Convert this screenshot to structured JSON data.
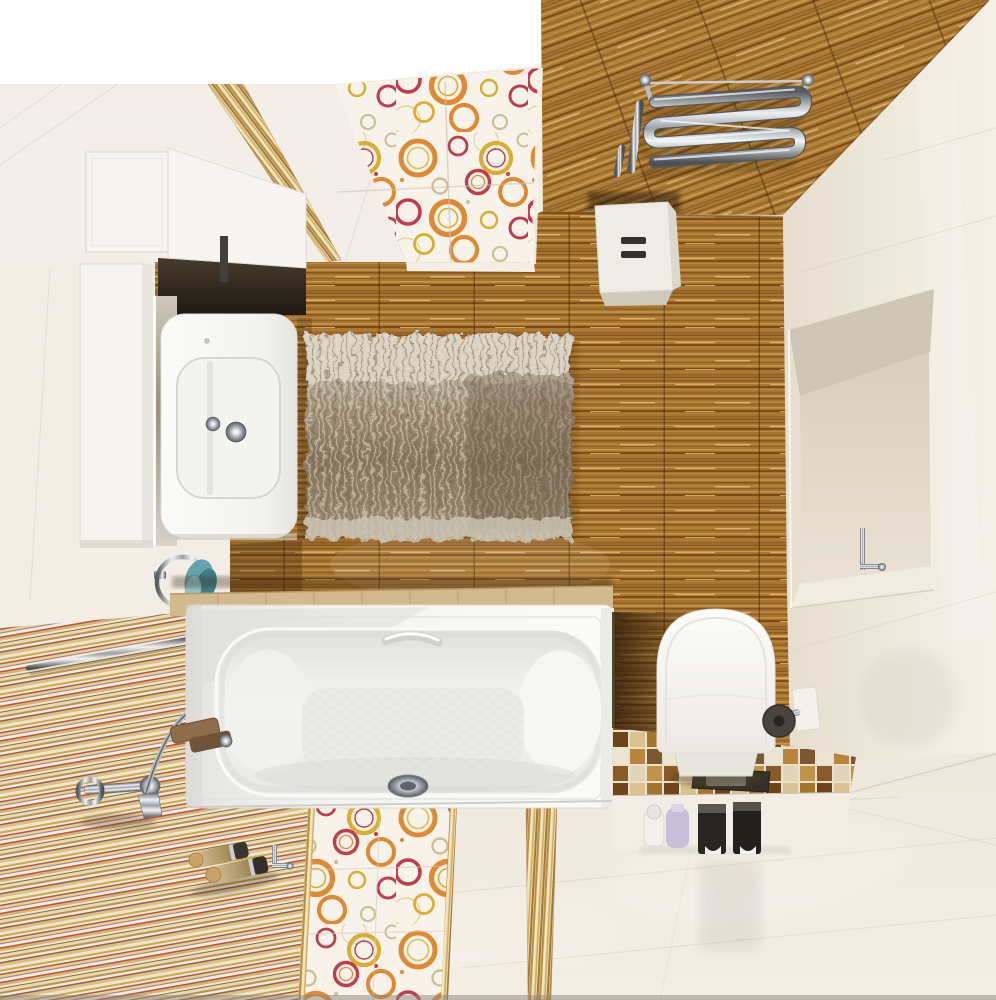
{
  "scene": {
    "type": "interior-3d-render",
    "caption": "Top-down 3D render of a compact bathroom: white bathtub along striped accent wall, washbasin vanity with white cabinets and mirror at left, wood-look tile wall with shaggy rug in the center, chrome towel radiator on wood ceiling, wall-hung toilet on a brown mosaic platform at right, recessed niche in a cream tiled wall, glossy white tile floor with orange circle-pattern tile strips and gold listello borders. No text appears in the image.",
    "style": "photorealistic render, no visible text"
  },
  "palette": {
    "white_strip": "#ffffff",
    "ceiling_white": "#f3efe8",
    "wall_white": "#f2eee6",
    "wall_right": "#efe8db",
    "floor_white": "#f0eae0",
    "wood_base": "#a8752f",
    "wood_ceiling": "#ad7c35",
    "wood_dark": "#7c4e1c",
    "wood_light": "#d2a75e",
    "gold_listello": "#c9a158",
    "pattern_bg": "#f7f3ea",
    "circle_orange": "#df8a33",
    "circle_red": "#c13c4d",
    "circle_yellow": "#d9ae2e",
    "circle_beige": "#cdbf96",
    "stripe_base": "#efe5cf",
    "tub_white": "#f4f4f2",
    "basin_shade": "#e2e2e0",
    "toilet_white": "#fbfbf9",
    "rug_light": "#dbd4c4",
    "rug_dark": "#8a7963",
    "mosaic_grout": "#eae1cd",
    "mosaic_brown": "#8a5a28",
    "chrome_light": "#eef1f4",
    "chrome_dark": "#53575b",
    "teal_towel": "#66a3ad",
    "lavender_bottle": "#c6c1d8",
    "dispenser_black": "#292620",
    "ledge_tan": "#d3ba8e",
    "shadow_dark": "#2f1d0b"
  },
  "objects": [
    {
      "id": "wood-ceiling",
      "label": "wood-look tile ceiling panel"
    },
    {
      "id": "towel-radiator",
      "label": "chrome serpentine towel radiator"
    },
    {
      "id": "storage-box",
      "label": "white wall box with vent slots"
    },
    {
      "id": "pattern-ceiling-band",
      "label": "circle-pattern decor tile band"
    },
    {
      "id": "gold-border-band",
      "label": "gold striped listello border"
    },
    {
      "id": "wall-cabinets",
      "label": "white wall cabinets"
    },
    {
      "id": "mirror",
      "label": "mirror strip reflecting rug"
    },
    {
      "id": "washbasin",
      "label": "white washbasin with chrome tap"
    },
    {
      "id": "towel-ring",
      "label": "chrome towel ring with teal towel"
    },
    {
      "id": "shaggy-rug",
      "label": "beige shaggy rug"
    },
    {
      "id": "bathtub",
      "label": "white acrylic bathtub with drain and grab rail"
    },
    {
      "id": "bath-faucet",
      "label": "wall-mounted bath mixer with hand shower"
    },
    {
      "id": "towel-bar",
      "label": "chrome towel bar"
    },
    {
      "id": "striped-wall",
      "label": "multicolor striped tile wall"
    },
    {
      "id": "floor-pattern-strip",
      "label": "circle-pattern floor tile strip"
    },
    {
      "id": "niche",
      "label": "recessed wall niche with chrome hook"
    },
    {
      "id": "toilet",
      "label": "white toilet with closed lid"
    },
    {
      "id": "toilet-paper-holder",
      "label": "chrome toilet paper holder"
    },
    {
      "id": "mosaic-platform",
      "label": "brown mosaic platform with flush plate"
    },
    {
      "id": "dispensers",
      "label": "black soap dispensers and bottles"
    },
    {
      "id": "floor-bottles",
      "label": "two corked bottles on floor"
    }
  ]
}
